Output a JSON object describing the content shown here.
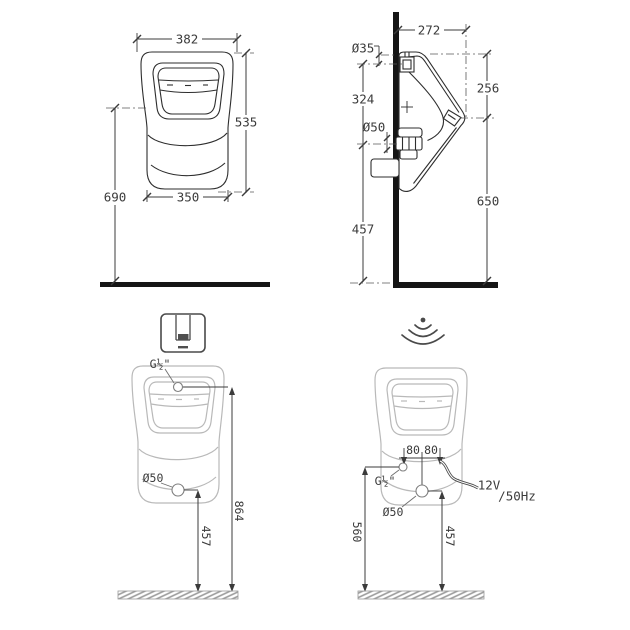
{
  "page": {
    "background": "#ffffff",
    "line_color": "#2e2e2e",
    "dim_color": "#3b3b3b",
    "ghost_color": "#b9b9b9",
    "structure_color": "#151515",
    "icon_color": "#4a4a4a"
  },
  "front_view": {
    "width_overall": "382",
    "height_bowl": "535",
    "height_rim_to_floor": "690",
    "width_lower": "350"
  },
  "side_view": {
    "depth_overall": "272",
    "inlet_diameter": "Ø35",
    "inlet_to_outlet": "324",
    "rim_drop": "256",
    "outlet_diameter": "Ø50",
    "rim_to_floor": "650",
    "outlet_to_floor": "457"
  },
  "manual_variant": {
    "icon": "push-button-flush-plate",
    "inlet_thread": "G½\"",
    "outlet_diameter": "Ø50",
    "outlet_to_floor": "457",
    "inlet_to_floor": "864"
  },
  "sensor_variant": {
    "icon": "infrared-sensor-waves",
    "offset_left": "80",
    "offset_right": "80",
    "inlet_thread": "G½\"",
    "outlet_diameter": "Ø50",
    "voltage": "12V",
    "frequency": "/50Hz",
    "inlet_to_floor": "560",
    "outlet_to_floor": "457"
  }
}
